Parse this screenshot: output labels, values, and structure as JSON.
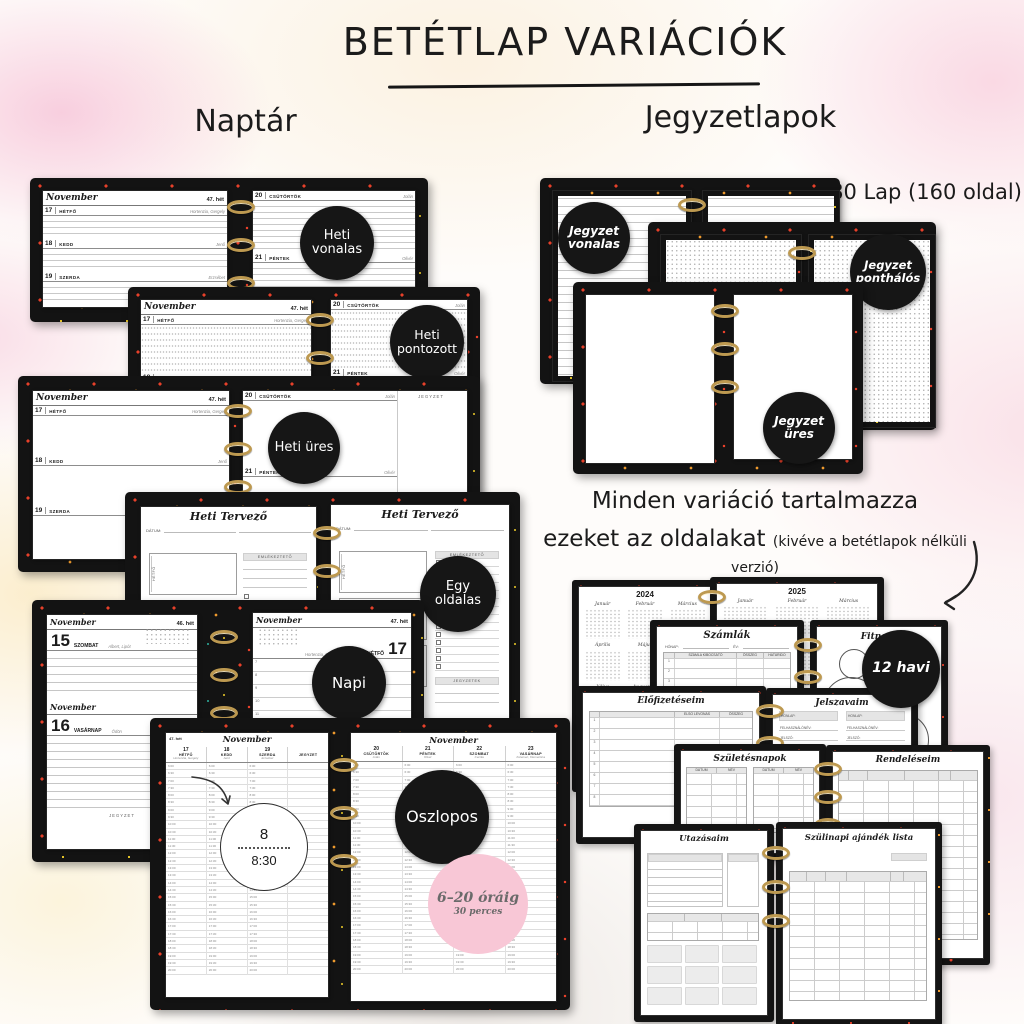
{
  "header": {
    "title": "BETÉTLAP VARIÁCIÓK",
    "naptar_heading": "Naptár",
    "jegyzetlapok_heading": "Jegyzetlapok",
    "capacity": "80 Lap (160 oldal)"
  },
  "common_note": {
    "line1": "Minden variáció tartalmazza",
    "line2": "ezeket az oldalakat",
    "paren": "(kivéve a betétlapok nélküli verzió)"
  },
  "labels": {
    "month": "November",
    "week46": "46. hét",
    "week47": "47. hét",
    "jegyzet": "JEGYZET",
    "datum": "DÁTUM:",
    "emlekezteto": "EMLÉKEZTETŐ",
    "jegyzetek": "JEGYZETEK",
    "honap": "HÓNAP:",
    "ev": "ÉV:"
  },
  "days": {
    "mon": {
      "num": "17",
      "name": "HÉTFŐ",
      "nameday": "Hortenzia, Gergely"
    },
    "tue": {
      "num": "18",
      "name": "KEDD",
      "nameday": "Jenő"
    },
    "wed": {
      "num": "19",
      "name": "SZERDA",
      "nameday": "Erzsébet"
    },
    "thu": {
      "num": "20",
      "name": "CSÜTÖRTÖK",
      "nameday": "Jolán"
    },
    "fri": {
      "num": "21",
      "name": "PÉNTEK",
      "nameday": "Olivér"
    },
    "sat": {
      "num": "15",
      "name": "SZOMBAT",
      "nameday": "Albert, Lipót"
    },
    "sun": {
      "num": "16",
      "name": "VASÁRNAP",
      "nameday": "Ödön"
    },
    "sat2": {
      "num": "22",
      "name": "SZOMBAT",
      "nameday": "Cecília"
    },
    "sun2": {
      "num": "23",
      "name": "VASÁRNAP",
      "nameday": "Kelemen, Klementina"
    }
  },
  "badges": {
    "heti_vonalas": "Heti vonalas",
    "heti_pontozott": "Heti pontozott",
    "heti_ures": "Heti üres",
    "egy_oldalas": "Egy oldalas",
    "napi": "Napi",
    "oszlopos": "Oszlopos",
    "jegyzet_vonalas": "Jegyzet vonalas",
    "jegyzet_ponthalos": "Jegyzet ponthálós",
    "jegyzet_ures": "Jegyzet üres",
    "tizenket_havi": "12 havi",
    "idosav": "6–20 óráig",
    "intervallum": "30 perces"
  },
  "heti_tervezo": {
    "title": "Heti Tervező",
    "box_monday": "HÉTFŐ",
    "box_tuesday": "KEDD"
  },
  "napi": {
    "hours": [
      "7",
      "8",
      "9",
      "10",
      "11",
      "12",
      "13",
      "14",
      "15",
      "16",
      "17",
      "18",
      "19"
    ]
  },
  "oszlopos": {
    "magnifier_top": "8",
    "magnifier_bottom": "8:30",
    "times": [
      "6:00",
      "6:30",
      "7:00",
      "7:30",
      "8:00",
      "8:30",
      "9:00",
      "9:30",
      "10:00",
      "10:30",
      "11:00",
      "11:30",
      "12:00",
      "12:30",
      "13:00",
      "13:30",
      "14:00",
      "14:30",
      "15:00",
      "15:30",
      "16:00",
      "16:30",
      "17:00",
      "17:30",
      "18:00",
      "18:30",
      "19:00",
      "19:30",
      "20:00"
    ]
  },
  "calendar": {
    "year_left": "2024",
    "year_right": "2025",
    "months": [
      "Január",
      "Február",
      "Március",
      "Április",
      "Május",
      "Június",
      "Július",
      "Augusztus",
      "Szeptember",
      "Október",
      "November",
      "December"
    ]
  },
  "pages": {
    "szamlak": {
      "title": "Számlák",
      "headers": [
        "SZÁMLA KIBOCSÁTÓ",
        "ÖSSZEG",
        "HATÁRIDŐ"
      ],
      "rows": [
        "1",
        "2",
        "3",
        "4",
        "5",
        "6",
        "7",
        "8"
      ]
    },
    "fitnesz": {
      "title": "Fitnesz"
    },
    "elofizetesek": {
      "title": "Előfizetéseim",
      "col_levonas": "ELSŐ LEVONÁS",
      "col_osszeg": "ÖSSZEG"
    },
    "jelszavak": {
      "title": "Jelszavaim",
      "fields": [
        "HONLAP:",
        "FELHASZNÁLÓNÉV:",
        "JELSZÓ:",
        "EMAIL:",
        "EGYÉB:"
      ]
    },
    "szuletesnapok": {
      "title": "Születésnapok",
      "col_datum": "DÁTUM",
      "col_nev": "NÉV"
    },
    "rendelesek": {
      "title": "Rendeléseim"
    },
    "utazasok": {
      "title": "Utazásaim"
    },
    "szulinapi": {
      "title": "Szülinapi ajándék lista"
    }
  }
}
